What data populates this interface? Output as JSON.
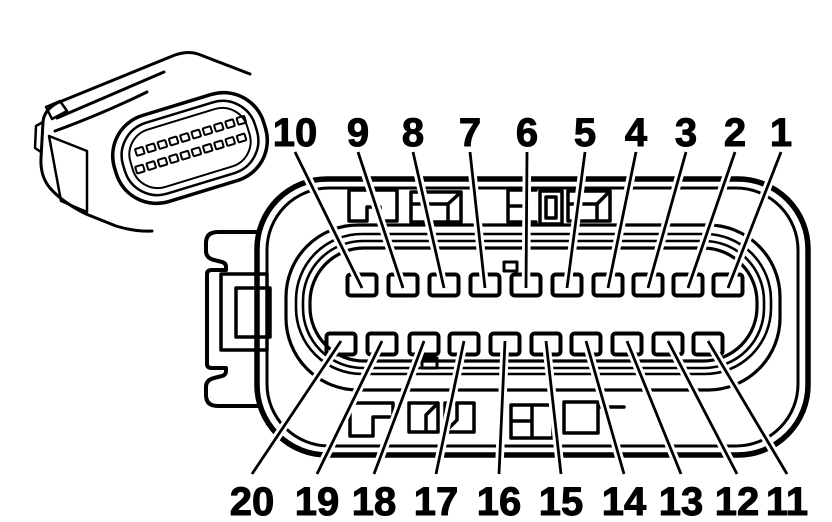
{
  "figure": {
    "kind": "electrical-connector-pinout-line-drawing",
    "ink_color": "#000000",
    "background_color": "#ffffff",
    "views": [
      "connector-3d-perspective-view",
      "connector-face-pinout-view"
    ],
    "pin_count": 20
  },
  "top_row": {
    "labels": [
      "10",
      "9",
      "8",
      "7",
      "6",
      "5",
      "4",
      "3",
      "2",
      "1"
    ],
    "label_x": [
      295,
      358,
      413,
      470,
      527,
      585,
      636,
      686,
      735,
      781
    ],
    "label_baseline_y": 146,
    "leader_start_y": 152,
    "pin_x": [
      362,
      403,
      444,
      485,
      526,
      567,
      608,
      648,
      688,
      728
    ],
    "pin_y": 285,
    "gap_side": "top"
  },
  "bottom_row": {
    "labels": [
      "20",
      "19",
      "18",
      "17",
      "16",
      "15",
      "14",
      "13",
      "12",
      "11"
    ],
    "label_x": [
      252,
      317,
      374,
      436,
      499,
      561,
      624,
      681,
      737,
      787
    ],
    "label_baseline_y": 515,
    "leader_start_y": 474,
    "pin_x": [
      341,
      382,
      424,
      464,
      505,
      546,
      586,
      627,
      668,
      708
    ],
    "pin_y": 344,
    "gap_side": "bottom"
  },
  "pin_style": {
    "width": 29,
    "height": 21,
    "corner_radius": 3,
    "stroke_width": 4
  },
  "leader_style": {
    "stroke_width": 2.8,
    "halo_width": 8.5
  },
  "label_style": {
    "font_size": 40
  }
}
